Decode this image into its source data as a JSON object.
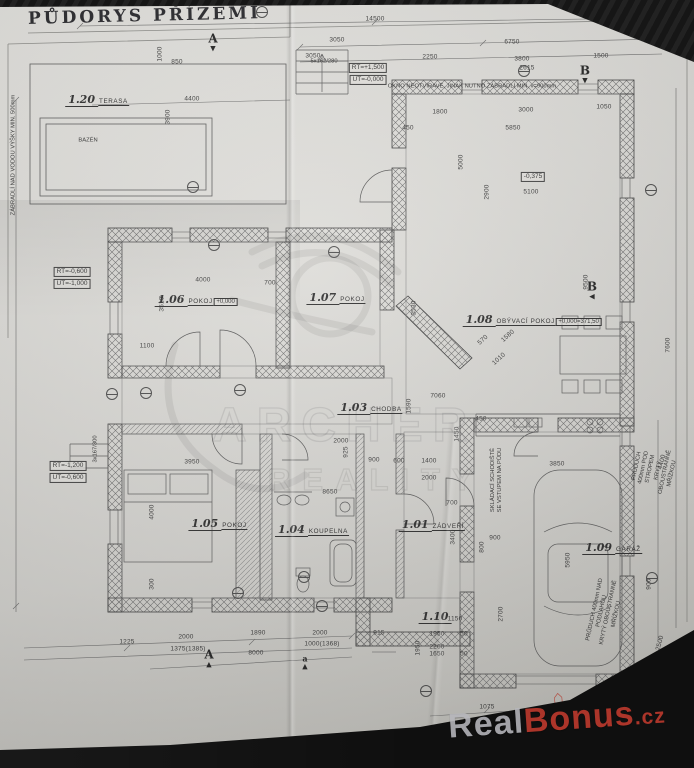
{
  "title": "PŮDORYS PŘÍZEMÍ",
  "watermarks": {
    "center_line1": "ARCHER",
    "center_line2": "REALITY",
    "brand": {
      "real": "Real",
      "bonus": "Bonus",
      "tld": ".cz"
    },
    "houses": [
      {
        "x": 558,
        "y": 697,
        "s": 18
      },
      {
        "x": 582,
        "y": 706,
        "s": 12
      },
      {
        "x": 602,
        "y": 694,
        "s": 14
      },
      {
        "x": 648,
        "y": 694,
        "s": 20
      },
      {
        "x": 670,
        "y": 707,
        "s": 13
      }
    ]
  },
  "colors": {
    "paper": "#dbdad6",
    "ink": "#3c3c3c",
    "brand_red": "#c23b2e",
    "brand_silver": "#b7b7bc"
  },
  "plan": {
    "rooms": [
      {
        "id": "1.20",
        "name": "TERASA",
        "x": 97,
        "y": 90
      },
      {
        "id": "1.06",
        "name": "POKOJ",
        "extra": "+0,000",
        "x": 196,
        "y": 290
      },
      {
        "id": "1.07",
        "name": "POKOJ",
        "x": 336,
        "y": 288
      },
      {
        "id": "1.08",
        "name": "OBÝVACÍ POKOJ",
        "extra": "+0,000=371,50",
        "x": 532,
        "y": 310
      },
      {
        "id": "1.03",
        "name": "CHODBA",
        "x": 370,
        "y": 398
      },
      {
        "id": "1.05",
        "name": "POKOJ",
        "x": 218,
        "y": 514
      },
      {
        "id": "1.04",
        "name": "KOUPELNA",
        "x": 312,
        "y": 520
      },
      {
        "id": "1.01",
        "name": "ZÁDVEŘÍ",
        "x": 432,
        "y": 515
      },
      {
        "id": "1.09",
        "name": "GARÁŽ",
        "x": 612,
        "y": 538
      },
      {
        "id": "1.10",
        "name": "",
        "x": 435,
        "y": 607
      }
    ],
    "dims": [
      {
        "t": "14500",
        "x": 375,
        "y": 19
      },
      {
        "t": "3050",
        "x": 337,
        "y": 40
      },
      {
        "t": "6750",
        "x": 512,
        "y": 42
      },
      {
        "t": "3050",
        "x": 313,
        "y": 56
      },
      {
        "t": "2250",
        "x": 430,
        "y": 57
      },
      {
        "t": "3800",
        "x": 522,
        "y": 59
      },
      {
        "t": "1500",
        "x": 601,
        "y": 56
      },
      {
        "t": "2615",
        "x": 527,
        "y": 68
      },
      {
        "t": "4400",
        "x": 192,
        "y": 99
      },
      {
        "t": "850",
        "x": 177,
        "y": 62
      },
      {
        "t": "1000",
        "x": 160,
        "y": 54,
        "r": -90
      },
      {
        "t": "3900",
        "x": 168,
        "y": 117,
        "r": -90
      },
      {
        "t": "1800",
        "x": 440,
        "y": 112
      },
      {
        "t": "3000",
        "x": 526,
        "y": 110
      },
      {
        "t": "1050",
        "x": 604,
        "y": 107
      },
      {
        "t": "450",
        "x": 408,
        "y": 128
      },
      {
        "t": "5850",
        "x": 513,
        "y": 128
      },
      {
        "t": "5000",
        "x": 461,
        "y": 162,
        "r": -90
      },
      {
        "t": "2900",
        "x": 487,
        "y": 192,
        "r": -90
      },
      {
        "t": "5100",
        "x": 531,
        "y": 192
      },
      {
        "t": "4000",
        "x": 203,
        "y": 280
      },
      {
        "t": "700",
        "x": 270,
        "y": 283
      },
      {
        "t": "3510",
        "x": 162,
        "y": 304,
        "r": -90
      },
      {
        "t": "1100",
        "x": 147,
        "y": 346
      },
      {
        "t": "3530",
        "x": 414,
        "y": 308,
        "r": -90
      },
      {
        "t": "570",
        "x": 483,
        "y": 340,
        "r": -42
      },
      {
        "t": "1580",
        "x": 508,
        "y": 336,
        "r": -42
      },
      {
        "t": "1010",
        "x": 499,
        "y": 359,
        "r": -42
      },
      {
        "t": "9500",
        "x": 586,
        "y": 282,
        "r": -90
      },
      {
        "t": "7600",
        "x": 668,
        "y": 345,
        "r": -90
      },
      {
        "t": "7060",
        "x": 438,
        "y": 396
      },
      {
        "t": "1590",
        "x": 409,
        "y": 406,
        "r": -90
      },
      {
        "t": "450",
        "x": 481,
        "y": 419
      },
      {
        "t": "1450",
        "x": 457,
        "y": 434,
        "r": -90
      },
      {
        "t": "900",
        "x": 374,
        "y": 460
      },
      {
        "t": "600",
        "x": 399,
        "y": 461
      },
      {
        "t": "1400",
        "x": 429,
        "y": 461
      },
      {
        "t": "2000",
        "x": 429,
        "y": 478
      },
      {
        "t": "925",
        "x": 346,
        "y": 452,
        "r": -90
      },
      {
        "t": "2000",
        "x": 341,
        "y": 441
      },
      {
        "t": "4000",
        "x": 152,
        "y": 512,
        "r": -90
      },
      {
        "t": "300",
        "x": 152,
        "y": 584,
        "r": -90
      },
      {
        "t": "3950",
        "x": 192,
        "y": 462
      },
      {
        "t": "8650",
        "x": 330,
        "y": 492
      },
      {
        "t": "3400",
        "x": 453,
        "y": 537,
        "r": -90
      },
      {
        "t": "700",
        "x": 452,
        "y": 503
      },
      {
        "t": "800",
        "x": 482,
        "y": 547,
        "r": -90
      },
      {
        "t": "900",
        "x": 495,
        "y": 538
      },
      {
        "t": "5950",
        "x": 568,
        "y": 560,
        "r": -90
      },
      {
        "t": "3850",
        "x": 557,
        "y": 464
      },
      {
        "t": "900",
        "x": 649,
        "y": 584,
        "r": -90
      },
      {
        "t": "2500",
        "x": 660,
        "y": 643,
        "r": -75
      },
      {
        "t": "2700",
        "x": 501,
        "y": 614,
        "r": -90
      },
      {
        "t": "4400",
        "x": 662,
        "y": 462,
        "r": -75
      },
      {
        "t": "1150",
        "x": 455,
        "y": 619
      },
      {
        "t": "1950",
        "x": 437,
        "y": 634
      },
      {
        "t": "50",
        "x": 464,
        "y": 634
      },
      {
        "t": "2260",
        "x": 437,
        "y": 647
      },
      {
        "t": "1650",
        "x": 437,
        "y": 654
      },
      {
        "t": "50",
        "x": 464,
        "y": 654
      },
      {
        "t": "915",
        "x": 379,
        "y": 633
      },
      {
        "t": "1950",
        "x": 418,
        "y": 648,
        "r": -90
      },
      {
        "t": "1225",
        "x": 127,
        "y": 642
      },
      {
        "t": "2000",
        "x": 186,
        "y": 637
      },
      {
        "t": "1375(1385)",
        "x": 188,
        "y": 649
      },
      {
        "t": "1890",
        "x": 258,
        "y": 633
      },
      {
        "t": "2000",
        "x": 320,
        "y": 633
      },
      {
        "t": "1000(1368)",
        "x": 322,
        "y": 644
      },
      {
        "t": "8000",
        "x": 256,
        "y": 653
      },
      {
        "t": "1075",
        "x": 487,
        "y": 707
      },
      {
        "t": "2462",
        "x": 552,
        "y": 708
      },
      {
        "t": "2260",
        "x": 553,
        "y": 717
      },
      {
        "t": "1650",
        "x": 555,
        "y": 724
      },
      {
        "t": "1025",
        "x": 619,
        "y": 712
      },
      {
        "t": "16500",
        "x": 365,
        "y": 745
      }
    ],
    "notes": [
      {
        "t": "OKNO NEOTVÍRAVÉ, JINAK NUTNO ZÁBRADLÍ MIN. v=900mm",
        "x": 472,
        "y": 87,
        "small": true
      },
      {
        "t": "RT=+1,500",
        "x": 368,
        "y": 68,
        "boxed": true
      },
      {
        "t": "UT=-0,000",
        "x": 368,
        "y": 80,
        "boxed": true
      },
      {
        "t": "RT=-0,600",
        "x": 72,
        "y": 272,
        "boxed": true
      },
      {
        "t": "UT=-1,000",
        "x": 72,
        "y": 284,
        "boxed": true
      },
      {
        "t": "RT=-1,200",
        "x": 68,
        "y": 466,
        "boxed": true
      },
      {
        "t": "UT=-0,600",
        "x": 68,
        "y": 478,
        "boxed": true
      },
      {
        "t": "-0,375",
        "x": 533,
        "y": 177,
        "boxed": true
      },
      {
        "t": "5x162/280",
        "x": 324,
        "y": 62,
        "small": true
      },
      {
        "t": "3x167/300",
        "x": 96,
        "y": 449,
        "r": -90,
        "small": true
      },
      {
        "t": "SKLÁDACÍ SCHODIŠTĚ\nSE VSTUPEM NA PŮDU",
        "x": 497,
        "y": 480,
        "r": -90,
        "small": true
      },
      {
        "t": "PRŮDUCH 400mm POD STROPEM\nKRYTÝ OBOUSTRANNĚ MŘÍŽKOU",
        "x": 655,
        "y": 470,
        "r": -78,
        "small": true
      },
      {
        "t": "PRŮDUCH 400mm NAD PODLAHOU\nKRYTÝ OBOUSTRANNĚ MŘÍŽKOU",
        "x": 606,
        "y": 612,
        "r": -78,
        "small": true
      },
      {
        "t": "ZÁBRADLÍ NAD VODOU VÝŠKY MIN. 500mm",
        "x": 14,
        "y": 155,
        "r": -90,
        "small": true
      },
      {
        "t": "BAZÉN",
        "x": 88,
        "y": 141,
        "small": true
      }
    ],
    "section_markers": [
      {
        "t": "A",
        "x": 213,
        "y": 42,
        "d": "▼"
      },
      {
        "t": "B",
        "x": 585,
        "y": 74,
        "d": "▼"
      },
      {
        "t": "B",
        "x": 592,
        "y": 290,
        "d": "◀"
      },
      {
        "t": "A",
        "x": 209,
        "y": 658,
        "d": "▲"
      },
      {
        "t": "a",
        "x": 305,
        "y": 662,
        "d": "▲",
        "small": true
      }
    ],
    "ref_bubbles": [
      {
        "x": 262,
        "y": 12
      },
      {
        "x": 524,
        "y": 71
      },
      {
        "x": 193,
        "y": 187
      },
      {
        "x": 651,
        "y": 190
      },
      {
        "x": 214,
        "y": 245
      },
      {
        "x": 334,
        "y": 252
      },
      {
        "x": 146,
        "y": 393
      },
      {
        "x": 240,
        "y": 390
      },
      {
        "x": 238,
        "y": 593
      },
      {
        "x": 322,
        "y": 606
      },
      {
        "x": 426,
        "y": 691
      },
      {
        "x": 518,
        "y": 717
      },
      {
        "x": 652,
        "y": 578
      },
      {
        "x": 304,
        "y": 577
      },
      {
        "x": 112,
        "y": 394
      }
    ]
  }
}
